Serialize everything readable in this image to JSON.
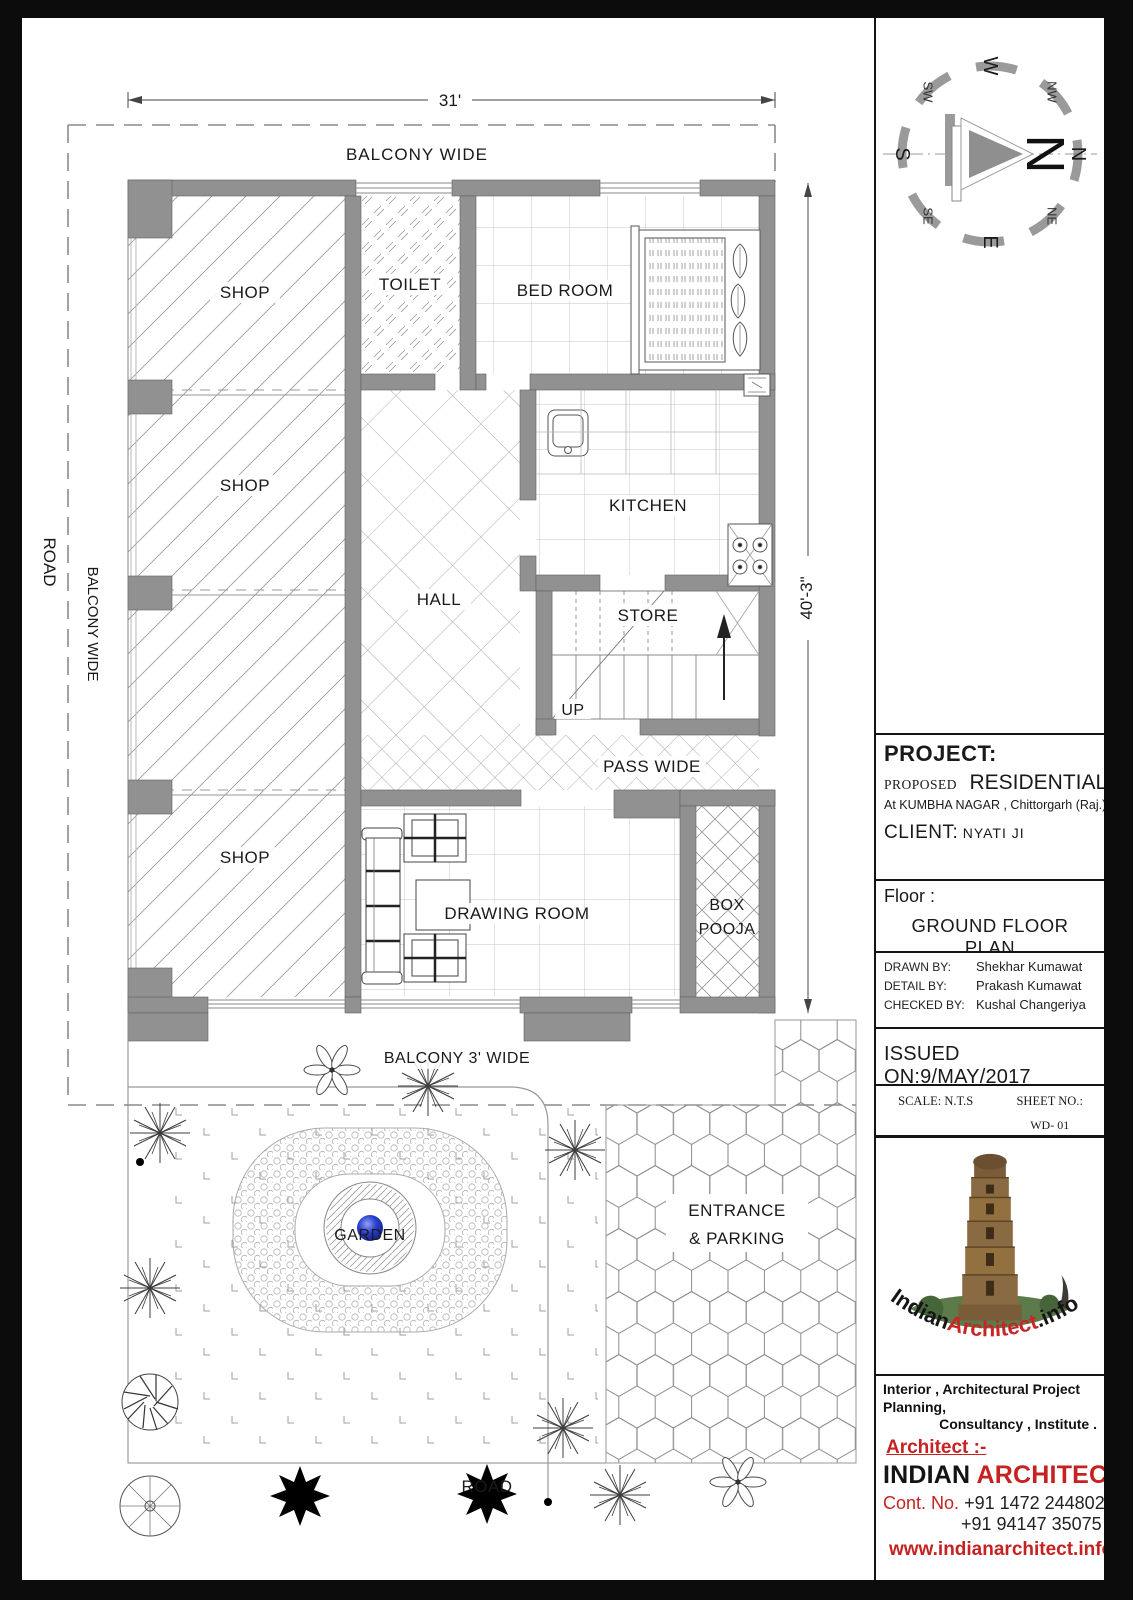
{
  "plan": {
    "dims": {
      "width": "31'",
      "height": "40'-3\""
    },
    "labels": {
      "balcony_top": "BALCONY WIDE",
      "road_left": "ROAD",
      "balcony_left": "BALCONY WIDE",
      "shop": "SHOP",
      "toilet": "TOILET",
      "bedroom": "BED ROOM",
      "hall": "HALL",
      "kitchen": "KITCHEN",
      "store": "STORE",
      "up": "UP",
      "pass": "PASS WIDE",
      "drawing_room": "DRAWING ROOM",
      "pooja_l1": "BOX",
      "pooja_l2": "POOJA",
      "balcony_bottom": "BALCONY  3' WIDE",
      "garden": "GARDEN",
      "entrance_l1": "ENTRANCE",
      "entrance_l2": "& PARKING",
      "road_bottom": "ROAD"
    }
  },
  "compass": {
    "n": "N",
    "ne": "NE",
    "e": "E",
    "se": "SE",
    "s": "S",
    "sw": "SW",
    "w": "W",
    "nw": "NW",
    "needle": "N"
  },
  "titleblock": {
    "project_label": "PROJECT:",
    "proposed": "PROPOSED",
    "project_type": "RESIDENTIAL",
    "location": "At  KUMBHA  NAGAR , Chittorgarh (Raj.)",
    "client_label": "CLIENT:",
    "client_name": "NYATI  JI",
    "floor_label": "Floor :",
    "floor_value": "GROUND FLOOR PLAN",
    "drawn_by_label": "DRAWN BY:",
    "drawn_by": "Shekhar Kumawat",
    "detail_by_label": "DETAIL BY:",
    "detail_by": "Prakash Kumawat",
    "checked_by_label": "CHECKED BY:",
    "checked_by": "Kushal Changeriya",
    "issued_on": "ISSUED ON:9/MAY/2017",
    "scale": "SCALE: N.T.S",
    "sheet_label": "SHEET NO.:",
    "sheet_no": "WD- 01"
  },
  "logo": {
    "part1": "Indian",
    "part2": "Architect",
    "part3": ".info"
  },
  "contact": {
    "services_line1": "Interior , Architectural Project Planning,",
    "services_line2": "Consultancy , Institute .",
    "architect_label": "Architect :-",
    "brand_part1": "INDIAN",
    "brand_part2": "ARCHITECT",
    "brand_part3": ".INFO",
    "contact_label": "Cont. No.",
    "phone1": "+91 1472 244802",
    "phone1_suffix": "(o)",
    "phone2": "+91 94147 35075",
    "website": "www.indianarchitect.info",
    "email": "info@.indianarchitect.info"
  },
  "icons": {
    "phone_glyph": "☎",
    "email_glyph": "✉"
  },
  "colors": {
    "wall_gray": "#919191",
    "accent_red": "#c62222",
    "whatsapp_green": "#2bb741",
    "fountain_blue": "#2b3fd1"
  }
}
